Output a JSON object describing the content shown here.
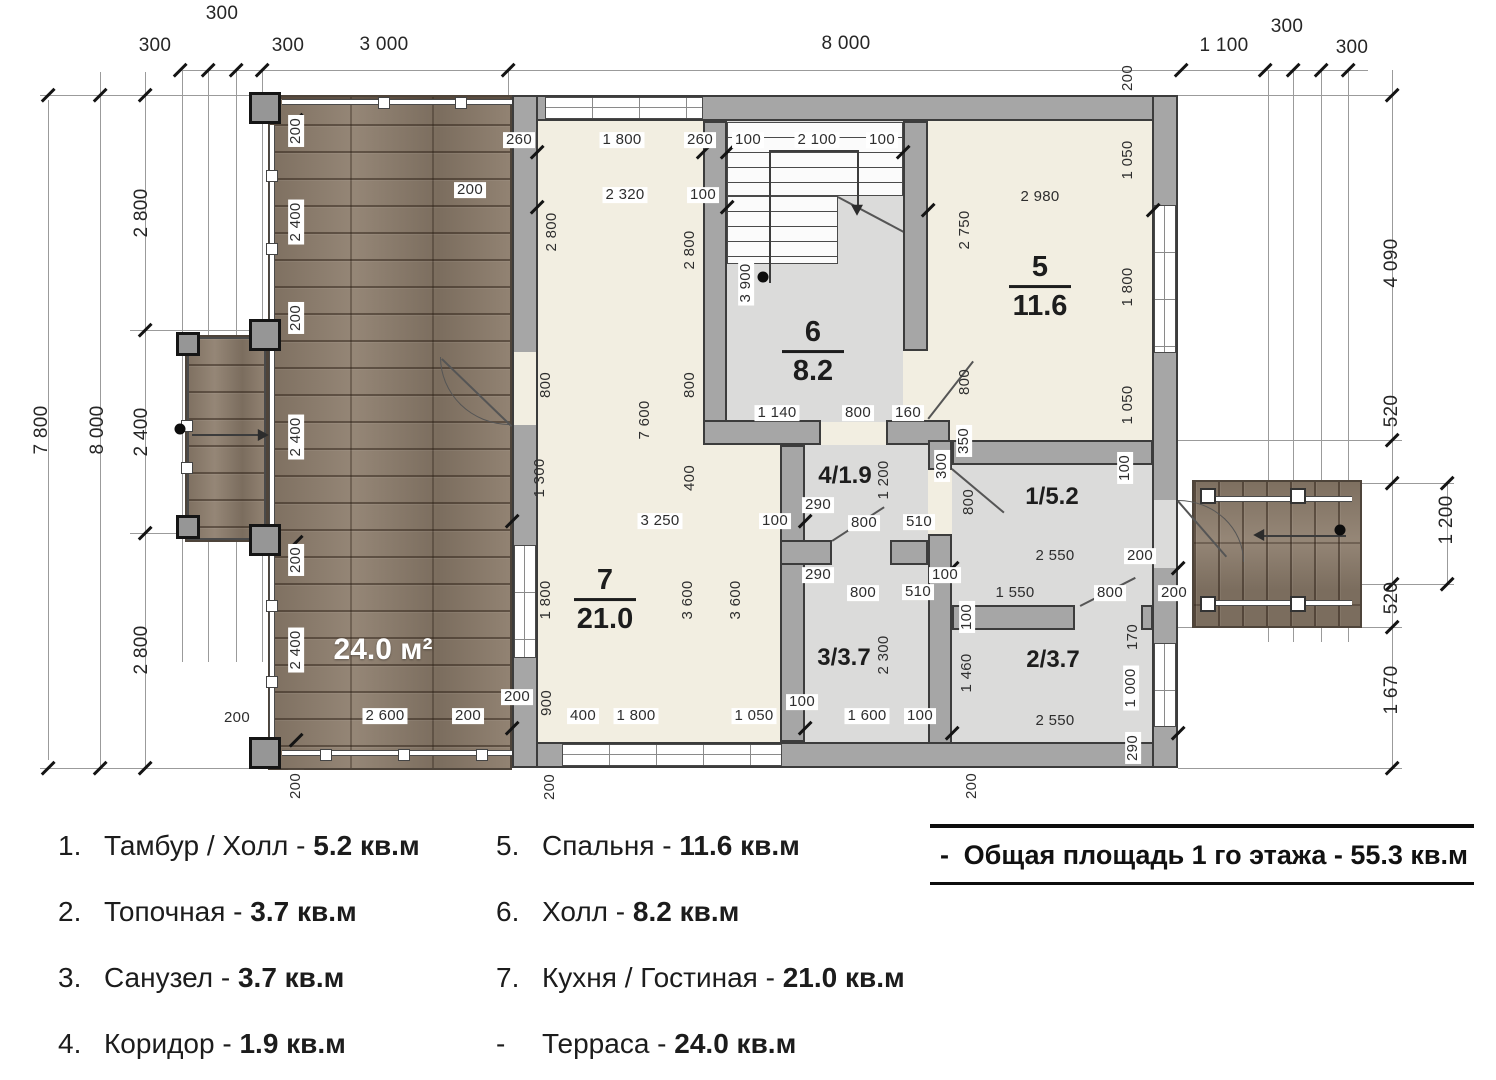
{
  "plan": {
    "terrace_label": {
      "text": "24.0 м²",
      "x": 383,
      "y": 650
    },
    "rooms": [
      {
        "name": "room-7-kuhnya-gostinaya",
        "style": "frac",
        "num": "7",
        "area": "21.0",
        "x": 605,
        "y": 600
      },
      {
        "name": "room-6-hall",
        "style": "frac",
        "num": "6",
        "area": "8.2",
        "x": 813,
        "y": 352
      },
      {
        "name": "room-5-spalnya",
        "style": "frac",
        "num": "5",
        "area": "11.6",
        "x": 1040,
        "y": 287
      },
      {
        "name": "room-1-tambur-hall",
        "style": "inline",
        "num": "1",
        "area": "5.2",
        "x": 1052,
        "y": 497
      },
      {
        "name": "room-4-koridor",
        "style": "inline",
        "num": "4",
        "area": "1.9",
        "x": 845,
        "y": 476
      },
      {
        "name": "room-3-sanuzel",
        "style": "inline",
        "num": "3",
        "area": "3.7",
        "x": 844,
        "y": 658
      },
      {
        "name": "room-2-topochnaya",
        "style": "inline",
        "num": "2",
        "area": "3.7",
        "x": 1053,
        "y": 660
      }
    ],
    "dims": [
      {
        "t": "300",
        "x": 222,
        "y": 14,
        "big": 1
      },
      {
        "t": "300",
        "x": 155,
        "y": 46,
        "big": 1
      },
      {
        "t": "300",
        "x": 288,
        "y": 46,
        "big": 1
      },
      {
        "t": "3 000",
        "x": 384,
        "y": 45,
        "big": 1
      },
      {
        "t": "8 000",
        "x": 846,
        "y": 44,
        "big": 1
      },
      {
        "t": "1 100",
        "x": 1224,
        "y": 46,
        "big": 1
      },
      {
        "t": "300",
        "x": 1287,
        "y": 27,
        "big": 1
      },
      {
        "t": "300",
        "x": 1352,
        "y": 48,
        "big": 1
      },
      {
        "t": "7 800",
        "x": 42,
        "y": 430,
        "r": 1,
        "big": 1
      },
      {
        "t": "8 000",
        "x": 98,
        "y": 430,
        "r": 1,
        "big": 1
      },
      {
        "t": "2 800",
        "x": 142,
        "y": 213,
        "r": 1,
        "big": 1
      },
      {
        "t": "2 400",
        "x": 142,
        "y": 432,
        "r": 1,
        "big": 1
      },
      {
        "t": "2 800",
        "x": 142,
        "y": 650,
        "r": 1,
        "big": 1
      },
      {
        "t": "4 090",
        "x": 1392,
        "y": 263,
        "r": 1,
        "big": 1
      },
      {
        "t": "520",
        "x": 1392,
        "y": 411,
        "r": 1,
        "big": 1
      },
      {
        "t": "1 200",
        "x": 1447,
        "y": 520,
        "r": 1,
        "big": 1
      },
      {
        "t": "520",
        "x": 1392,
        "y": 598,
        "r": 1,
        "big": 1
      },
      {
        "t": "1 670",
        "x": 1392,
        "y": 690,
        "r": 1,
        "big": 1
      },
      {
        "t": "200",
        "x": 1128,
        "y": 78,
        "r": 1
      },
      {
        "t": "200",
        "x": 296,
        "y": 131,
        "r": 1,
        "bg": 1
      },
      {
        "t": "2 400",
        "x": 296,
        "y": 222,
        "r": 1,
        "bg": 1
      },
      {
        "t": "200",
        "x": 296,
        "y": 318,
        "r": 1,
        "bg": 1
      },
      {
        "t": "2 400",
        "x": 296,
        "y": 437,
        "r": 1,
        "bg": 1
      },
      {
        "t": "200",
        "x": 296,
        "y": 560,
        "r": 1,
        "bg": 1
      },
      {
        "t": "2 400",
        "x": 296,
        "y": 650,
        "r": 1,
        "bg": 1
      },
      {
        "t": "200",
        "x": 296,
        "y": 786,
        "r": 1,
        "bg": 1
      },
      {
        "t": "200",
        "x": 470,
        "y": 190,
        "bg": 1
      },
      {
        "t": "2 600",
        "x": 385,
        "y": 716,
        "bg": 1
      },
      {
        "t": "200",
        "x": 237,
        "y": 718
      },
      {
        "t": "200",
        "x": 468,
        "y": 716,
        "bg": 1
      },
      {
        "t": "200",
        "x": 517,
        "y": 697,
        "bg": 1
      },
      {
        "t": "260",
        "x": 519,
        "y": 140,
        "bg": 1
      },
      {
        "t": "1 800",
        "x": 622,
        "y": 140,
        "bg": 1
      },
      {
        "t": "260",
        "x": 700,
        "y": 140,
        "bg": 1
      },
      {
        "t": "2 320",
        "x": 625,
        "y": 195,
        "bg": 1
      },
      {
        "t": "100",
        "x": 703,
        "y": 195,
        "bg": 1
      },
      {
        "t": "2 800",
        "x": 552,
        "y": 232,
        "r": 1
      },
      {
        "t": "2 800",
        "x": 690,
        "y": 250,
        "r": 1
      },
      {
        "t": "800",
        "x": 546,
        "y": 385,
        "r": 1
      },
      {
        "t": "800",
        "x": 690,
        "y": 385,
        "r": 1
      },
      {
        "t": "7 600",
        "x": 645,
        "y": 420,
        "r": 1
      },
      {
        "t": "1 300",
        "x": 540,
        "y": 478,
        "r": 1
      },
      {
        "t": "400",
        "x": 690,
        "y": 478,
        "r": 1
      },
      {
        "t": "1 800",
        "x": 546,
        "y": 600,
        "r": 1
      },
      {
        "t": "900",
        "x": 547,
        "y": 703,
        "r": 1
      },
      {
        "t": "3 600",
        "x": 688,
        "y": 600,
        "r": 1
      },
      {
        "t": "3 600",
        "x": 736,
        "y": 600,
        "r": 1
      },
      {
        "t": "3 250",
        "x": 660,
        "y": 521,
        "bg": 1
      },
      {
        "t": "100",
        "x": 775,
        "y": 521,
        "bg": 1
      },
      {
        "t": "400",
        "x": 583,
        "y": 716,
        "bg": 1
      },
      {
        "t": "1 800",
        "x": 636,
        "y": 716,
        "bg": 1
      },
      {
        "t": "1 050",
        "x": 754,
        "y": 716,
        "bg": 1
      },
      {
        "t": "200",
        "x": 550,
        "y": 787,
        "r": 1
      },
      {
        "t": "100",
        "x": 748,
        "y": 140,
        "bg": 1
      },
      {
        "t": "2 100",
        "x": 817,
        "y": 140,
        "bg": 1
      },
      {
        "t": "100",
        "x": 882,
        "y": 140,
        "bg": 1
      },
      {
        "t": "3 900",
        "x": 746,
        "y": 283,
        "r": 1,
        "bg": 1
      },
      {
        "t": "1 140",
        "x": 777,
        "y": 413,
        "bg": 1
      },
      {
        "t": "800",
        "x": 858,
        "y": 413,
        "bg": 1
      },
      {
        "t": "160",
        "x": 908,
        "y": 413,
        "bg": 1
      },
      {
        "t": "2 980",
        "x": 1040,
        "y": 197
      },
      {
        "t": "2 750",
        "x": 965,
        "y": 230,
        "r": 1
      },
      {
        "t": "1 050",
        "x": 1128,
        "y": 160,
        "r": 1
      },
      {
        "t": "1 800",
        "x": 1128,
        "y": 287,
        "r": 1
      },
      {
        "t": "1 050",
        "x": 1128,
        "y": 405,
        "r": 1
      },
      {
        "t": "800",
        "x": 965,
        "y": 382,
        "r": 1
      },
      {
        "t": "350",
        "x": 964,
        "y": 441,
        "r": 1,
        "bg": 1
      },
      {
        "t": "300",
        "x": 942,
        "y": 466,
        "r": 1,
        "bg": 1
      },
      {
        "t": "800",
        "x": 969,
        "y": 502,
        "r": 1
      },
      {
        "t": "100",
        "x": 967,
        "y": 617,
        "r": 1,
        "bg": 1
      },
      {
        "t": "1 460",
        "x": 967,
        "y": 673,
        "r": 1
      },
      {
        "t": "1 200",
        "x": 884,
        "y": 480,
        "r": 1
      },
      {
        "t": "290",
        "x": 818,
        "y": 505,
        "bg": 1
      },
      {
        "t": "800",
        "x": 864,
        "y": 523,
        "bg": 1
      },
      {
        "t": "510",
        "x": 919,
        "y": 522,
        "bg": 1
      },
      {
        "t": "290",
        "x": 818,
        "y": 575,
        "bg": 1
      },
      {
        "t": "800",
        "x": 863,
        "y": 593,
        "bg": 1
      },
      {
        "t": "510",
        "x": 918,
        "y": 592,
        "bg": 1
      },
      {
        "t": "100",
        "x": 945,
        "y": 575,
        "bg": 1
      },
      {
        "t": "2 300",
        "x": 884,
        "y": 655,
        "r": 1
      },
      {
        "t": "100",
        "x": 802,
        "y": 702,
        "bg": 1
      },
      {
        "t": "1 600",
        "x": 867,
        "y": 716,
        "bg": 1
      },
      {
        "t": "100",
        "x": 920,
        "y": 716,
        "bg": 1
      },
      {
        "t": "100",
        "x": 1125,
        "y": 468,
        "r": 1,
        "bg": 1
      },
      {
        "t": "2 550",
        "x": 1055,
        "y": 556
      },
      {
        "t": "200",
        "x": 1140,
        "y": 556,
        "bg": 1
      },
      {
        "t": "1 550",
        "x": 1015,
        "y": 593
      },
      {
        "t": "800",
        "x": 1110,
        "y": 593,
        "bg": 1
      },
      {
        "t": "200",
        "x": 1174,
        "y": 593,
        "bg": 1
      },
      {
        "t": "170",
        "x": 1133,
        "y": 637,
        "r": 1
      },
      {
        "t": "1 000",
        "x": 1131,
        "y": 688,
        "r": 1,
        "bg": 1
      },
      {
        "t": "2 550",
        "x": 1055,
        "y": 721
      },
      {
        "t": "290",
        "x": 1133,
        "y": 748,
        "r": 1,
        "bg": 1
      },
      {
        "t": "200",
        "x": 972,
        "y": 786,
        "r": 1
      }
    ]
  },
  "legend": {
    "col1": [
      {
        "num": "1.",
        "name": "Тамбур / Холл",
        "area": "5.2 кв.м"
      },
      {
        "num": "2.",
        "name": "Топочная",
        "area": "3.7 кв.м"
      },
      {
        "num": "3.",
        "name": "Санузел",
        "area": "3.7 кв.м"
      },
      {
        "num": "4.",
        "name": "Коридор",
        "area": "1.9 кв.м"
      }
    ],
    "col2": [
      {
        "num": "5.",
        "name": "Спальня",
        "area": "11.6 кв.м"
      },
      {
        "num": "6.",
        "name": "Холл",
        "area": "8.2 кв.м"
      },
      {
        "num": "7.",
        "name": "Кухня / Гостиная",
        "area": "21.0 кв.м"
      },
      {
        "num": "-",
        "name": "Терраса",
        "area": "24.0 кв.м"
      }
    ],
    "total": {
      "prefix": "-",
      "label": "Общая площадь 1 го этажа - 55.3 кв.м"
    }
  }
}
